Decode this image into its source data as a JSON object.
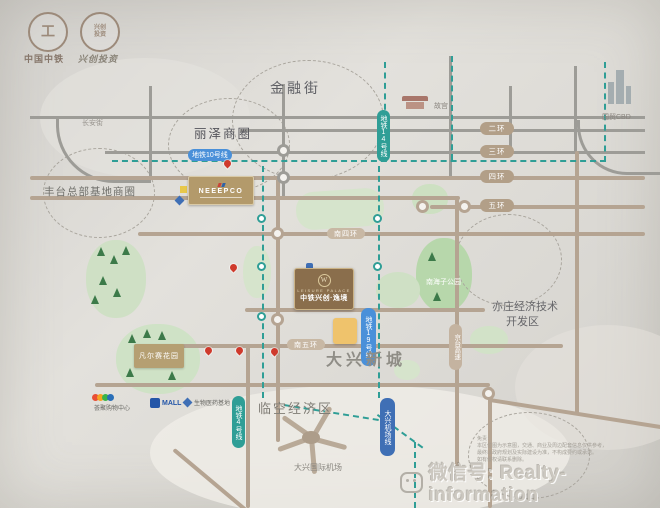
{
  "brand": {
    "logo1_mark": "工",
    "logo1_name": "中国中铁",
    "logo2_seal_row1": "兴创",
    "logo2_seal_row2": "投资",
    "logo2_name": "兴创投资"
  },
  "districts": {
    "jinrongjie": "金融街",
    "lize": "丽泽商圈",
    "changanjie": "长安街",
    "fengtai_hub": "丰台总部基地商圈",
    "daxing_newtown": "大兴新城",
    "linkong": "临空经济区",
    "yizhuang_line1": "亦庄经济技术",
    "yizhuang_line2": "开发区"
  },
  "landmarks": {
    "gugong": "故宫",
    "guomao_cbd": "国贸CBD",
    "airport": "大兴国际机场",
    "nanhaizi_park": "南海子公园",
    "versailles": "凡尔赛花园",
    "gold_plaza": "NEEEPCO"
  },
  "project": {
    "monogram": "W",
    "en_name": "LEISURE PALACE",
    "cn_name": "中铁兴创·逸境"
  },
  "metro": {
    "line10": "地铁10号线",
    "line14": "地铁14号线",
    "line19": "地铁19号线",
    "line4": "地铁4号线",
    "airport_express": "大兴机场线"
  },
  "roads": {
    "ring2": "二环",
    "ring3": "三环",
    "ring4": "四环",
    "ring5": "五环",
    "south_ring4": "南四环",
    "south_ring5": "南五环",
    "jingtai_expwy": "京台高速"
  },
  "malls": {
    "livat": "荟聚购物中心",
    "mall": "MALL",
    "biomedical": "生物医药基地"
  },
  "footer": {
    "disclaimer_line1": "免责：",
    "disclaimer_line2": "本区位图为示意图，交通、商业及周边配套信息仅供参考，",
    "disclaimer_line3": "最终以政府规划及实际建设为准，不构成要约或承诺。",
    "disclaimer_line4": "如有侵权请联系删除。"
  },
  "watermark": {
    "wechat_id": "微信号: Realty-information"
  }
}
